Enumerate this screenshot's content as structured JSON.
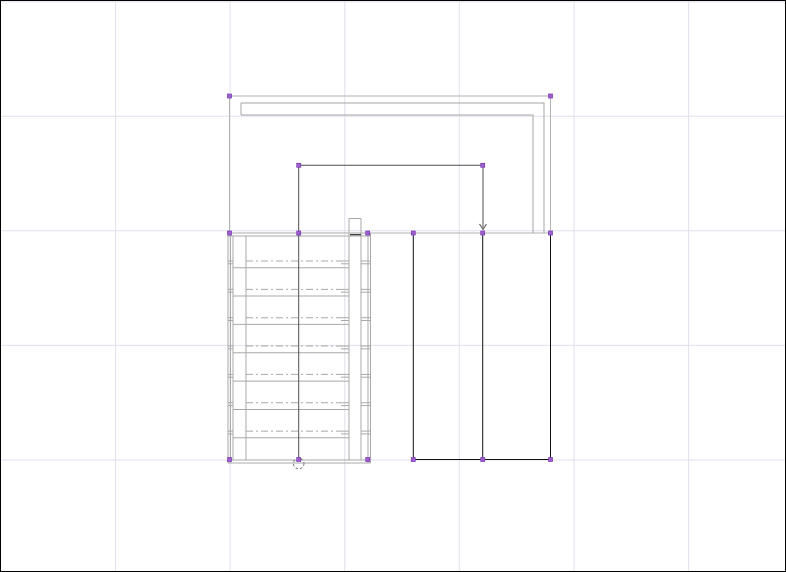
{
  "app": {
    "type": "cad-drawing-canvas",
    "content_description": "floor plan with selected staircase, walls and rooms"
  },
  "canvas": {
    "width": 786,
    "height": 572,
    "background": "#ffffff",
    "border_color": "#000000"
  },
  "grid": {
    "color": "#e1e1ec",
    "vertical_x": [
      115.5,
      230,
      344.7,
      459.3,
      574,
      688.6
    ],
    "horizontal_y": [
      1.7,
      116.3,
      230.8,
      345.4,
      460
    ]
  },
  "palette": {
    "selection_line": "#b2b2b2",
    "wall_line": "#a5a5a5",
    "stair_line": "#a8a8a8",
    "walk_line": "#4f4f4f",
    "solid_black": "#111111",
    "circle_line": "#7d7d7d",
    "grip_fill": "#a05ed2",
    "grip_stroke": "#7a3eb0"
  },
  "shapes": {
    "selection_outline": {
      "x1": 229.5,
      "y1": 96,
      "x2": 550.5,
      "y2": 233
    },
    "wall": {
      "outer": [
        [
          241,
          103
        ],
        [
          544,
          103
        ],
        [
          544,
          233
        ]
      ],
      "inner": [
        [
          241,
          115
        ],
        [
          533,
          115
        ],
        [
          533,
          233
        ]
      ],
      "cap": [
        [
          241,
          103
        ],
        [
          241,
          115
        ]
      ]
    },
    "stair": {
      "verticals": [
        {
          "x": 228,
          "y1": 233,
          "y2": 463
        },
        {
          "x": 230.5,
          "y1": 233,
          "y2": 463
        },
        {
          "x": 233,
          "y1": 236,
          "y2": 460
        },
        {
          "x": 246,
          "y1": 236,
          "y2": 460
        },
        {
          "x": 349,
          "y1": 218.5,
          "y2": 460
        },
        {
          "x": 361,
          "y1": 218.5,
          "y2": 460
        },
        {
          "x": 368,
          "y1": 233,
          "y2": 463
        },
        {
          "x": 370.5,
          "y1": 233,
          "y2": 463
        }
      ],
      "horizontals": [
        {
          "y": 218.5,
          "x1": 349,
          "x2": 361
        },
        {
          "y": 233,
          "x1": 228,
          "x2": 370.5
        },
        {
          "y": 236,
          "x1": 228,
          "x2": 370.5
        },
        {
          "y": 460,
          "x1": 228,
          "x2": 370.5
        },
        {
          "y": 463,
          "x1": 228,
          "x2": 370.5
        }
      ],
      "treads": {
        "count": 7,
        "first_dash_y": 261,
        "spacing": 28.35,
        "dash_x1": 246,
        "dash_x2": 341,
        "dash_pattern": "7 3 2 3",
        "solid_offset": 6.7,
        "solid_x1": 233,
        "solid_x2": 349,
        "tick_offset": 2.8,
        "tick_spans": [
          [
            228,
            233
          ],
          [
            341,
            349
          ],
          [
            361,
            370.5
          ]
        ]
      },
      "threshold": {
        "y": 234.7,
        "x1": 350,
        "x2": 361
      }
    },
    "walk_line": {
      "polyline": [
        [
          298.7,
          458
        ],
        [
          298.7,
          165.3
        ],
        [
          483,
          165.3
        ],
        [
          483,
          227.5
        ]
      ],
      "arrow": {
        "tip_x": 483,
        "tip_y": 229.5,
        "half_width": 3.5,
        "back": 5.5
      },
      "start_circle": {
        "cx": 298.7,
        "cy": 463.5,
        "r": 5.3,
        "dash_pattern": "2.5 2"
      }
    },
    "rooms": {
      "verticals": [
        {
          "x": 413.3,
          "y1": 233.5,
          "y2": 459.5
        },
        {
          "x": 482.7,
          "y1": 233.5,
          "y2": 459.5
        },
        {
          "x": 550.5,
          "y1": 233.5,
          "y2": 459.5
        }
      ],
      "bottom": {
        "y": 459.5,
        "x1": 413.3,
        "x2": 550.5
      }
    },
    "grips": {
      "size": 4,
      "points": [
        [
          229.5,
          96
        ],
        [
          550.5,
          96
        ],
        [
          298.7,
          165.3
        ],
        [
          482.7,
          165.3
        ],
        [
          229.5,
          233
        ],
        [
          298.7,
          233
        ],
        [
          367.7,
          233
        ],
        [
          413.3,
          233
        ],
        [
          482.7,
          233
        ],
        [
          550.5,
          233
        ],
        [
          229.5,
          459.5
        ],
        [
          298.7,
          459.5
        ],
        [
          367.7,
          459.5
        ],
        [
          413.3,
          459.5
        ],
        [
          482.7,
          459.5
        ],
        [
          550.5,
          459.5
        ]
      ]
    }
  }
}
